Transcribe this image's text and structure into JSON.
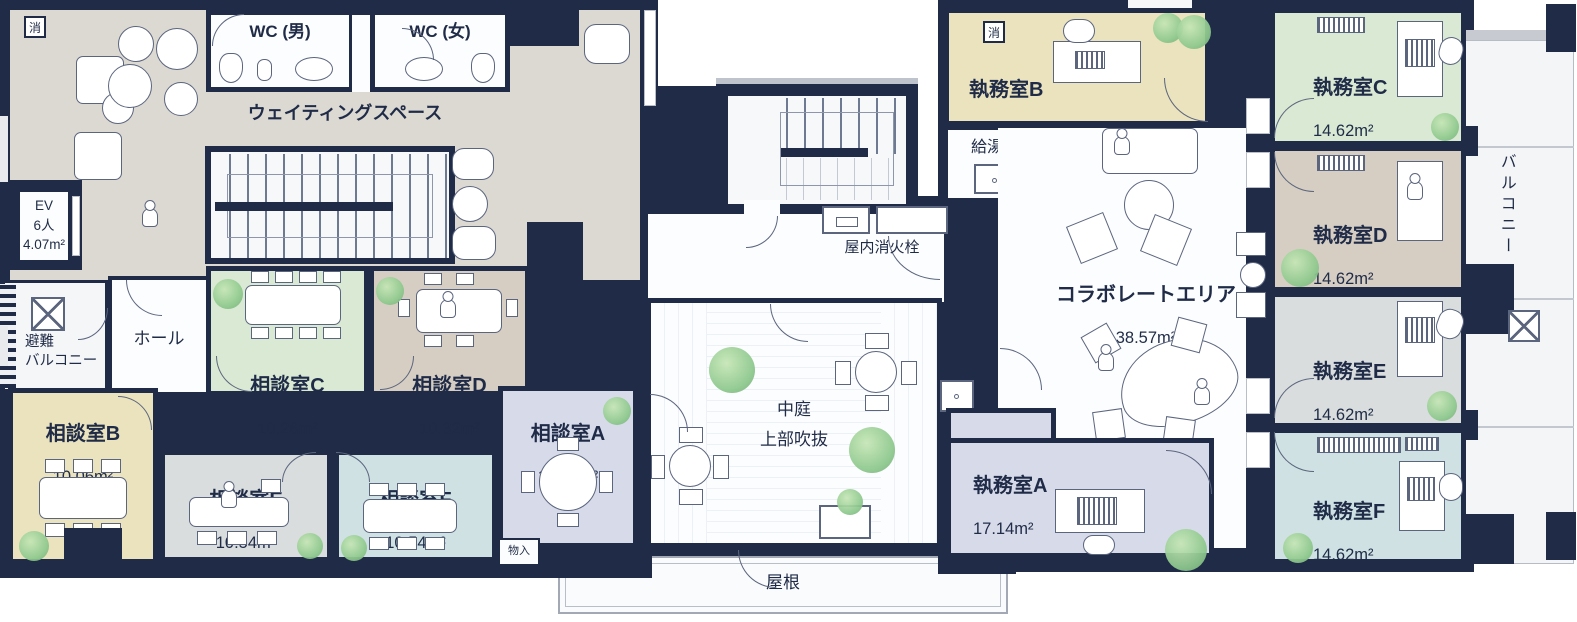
{
  "colors": {
    "wall": "#1f2b47",
    "line": "#5b657e",
    "waiting": "#dcd8d2",
    "cream": "#eae3bd",
    "green": "#d9e9d3",
    "tan": "#d6cec2",
    "gray": "#d9dddd",
    "teal": "#cfe1e2",
    "lavender": "#d7dbe9",
    "plant": "#8fc98e"
  },
  "rooms": {
    "waiting_space": {
      "name": "ウェイティングスペース"
    },
    "wc_men": {
      "name": "WC (男)"
    },
    "wc_women": {
      "name": "WC (女)"
    },
    "elevator": {
      "name": "EV\n6人\n4.07m²"
    },
    "escape_balcony": {
      "name": "避難\nバルコニー"
    },
    "hall": {
      "name": "ホール"
    },
    "consult_a": {
      "name": "相談室A",
      "area": "12.93m²"
    },
    "consult_b": {
      "name": "相談室B",
      "area": "10.06m²"
    },
    "consult_c": {
      "name": "相談室C",
      "area": "10.26m²"
    },
    "consult_d": {
      "name": "相談室D",
      "area": "10.32m²"
    },
    "consult_e": {
      "name": "相談室E",
      "area": "10.54m²"
    },
    "consult_f": {
      "name": "相談室F",
      "area": "10.54m²"
    },
    "storage": {
      "name": "物入"
    },
    "courtyard": {
      "name": "中庭\n上部吹抜"
    },
    "indoor_hydrant": {
      "name": "屋内消火栓"
    },
    "roof": {
      "name": "屋根"
    },
    "office_a": {
      "name": "執務室A",
      "area": "17.14m²"
    },
    "office_b": {
      "name": "執務室B",
      "area": "17.08m²"
    },
    "office_c": {
      "name": "執務室C",
      "area": "14.62m²"
    },
    "office_d": {
      "name": "執務室D",
      "area": "14.62m²"
    },
    "office_e": {
      "name": "執務室E",
      "area": "14.62m²"
    },
    "office_f": {
      "name": "執務室F",
      "area": "14.62m²"
    },
    "kitchenette": {
      "name": "給湯室"
    },
    "collaborate": {
      "name": "コラボレートエリア",
      "area": "38.57m²"
    },
    "balcony": {
      "name": "バルコニー"
    }
  },
  "symbols": {
    "fire_extinguisher": "消"
  }
}
